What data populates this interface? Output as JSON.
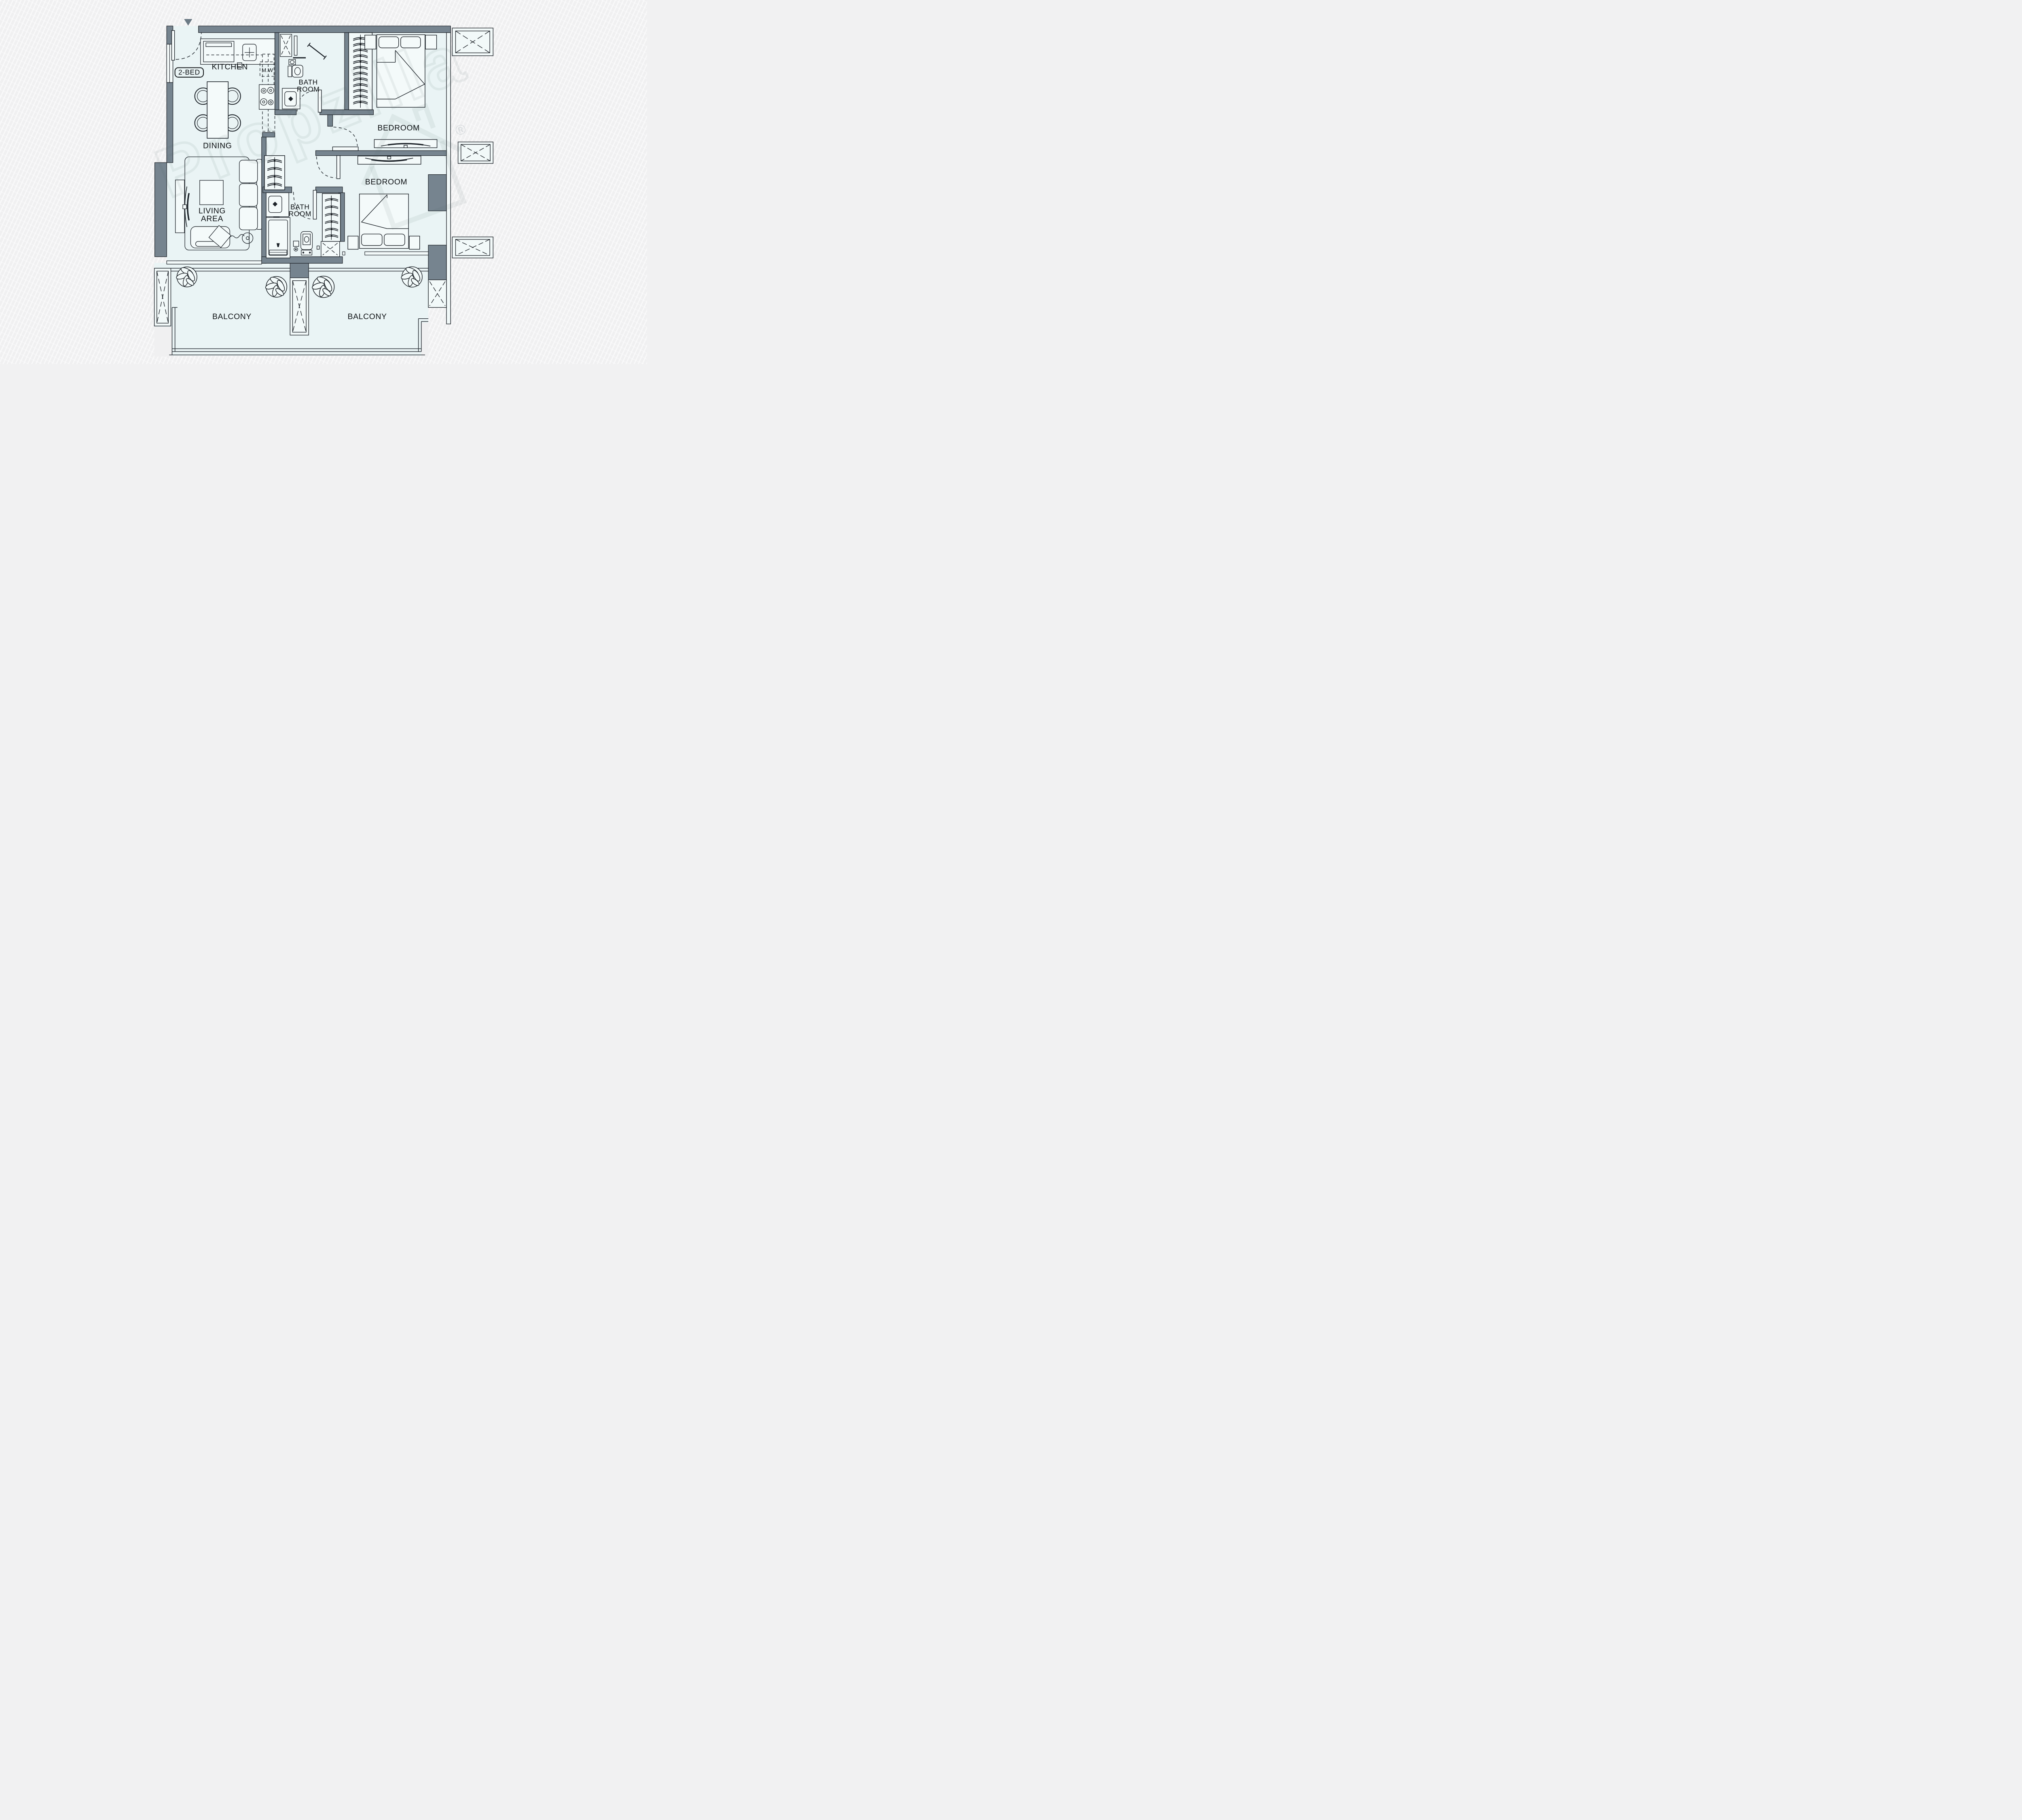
{
  "meta": {
    "document_type": "apartment floor plan",
    "unit_type": "2-BED"
  },
  "colors": {
    "background": "#f0f0f1",
    "floor": "#eaf4f5",
    "wall": "#76848f",
    "line": "#1d2329",
    "marker": "#6c7a85",
    "watermark": "rgba(80,100,110,0.09)"
  },
  "labels": {
    "unit_badge": "2-BED",
    "kitchen": "KITCHEN",
    "microwave": "M.W",
    "bath_top": {
      "l1": "BATH",
      "l2": "ROOM"
    },
    "bedroom_top": "BEDROOM",
    "dining": "DINING",
    "living": {
      "l1": "LIVING",
      "l2": "AREA"
    },
    "bath_mid": {
      "l1": "BATH",
      "l2": "ROOM"
    },
    "bedroom_mid": "BEDROOM",
    "balcony_left": "BALCONY",
    "balcony_right": "BALCONY"
  },
  "watermark": {
    "text": "Propzilla",
    "mark": "®"
  }
}
